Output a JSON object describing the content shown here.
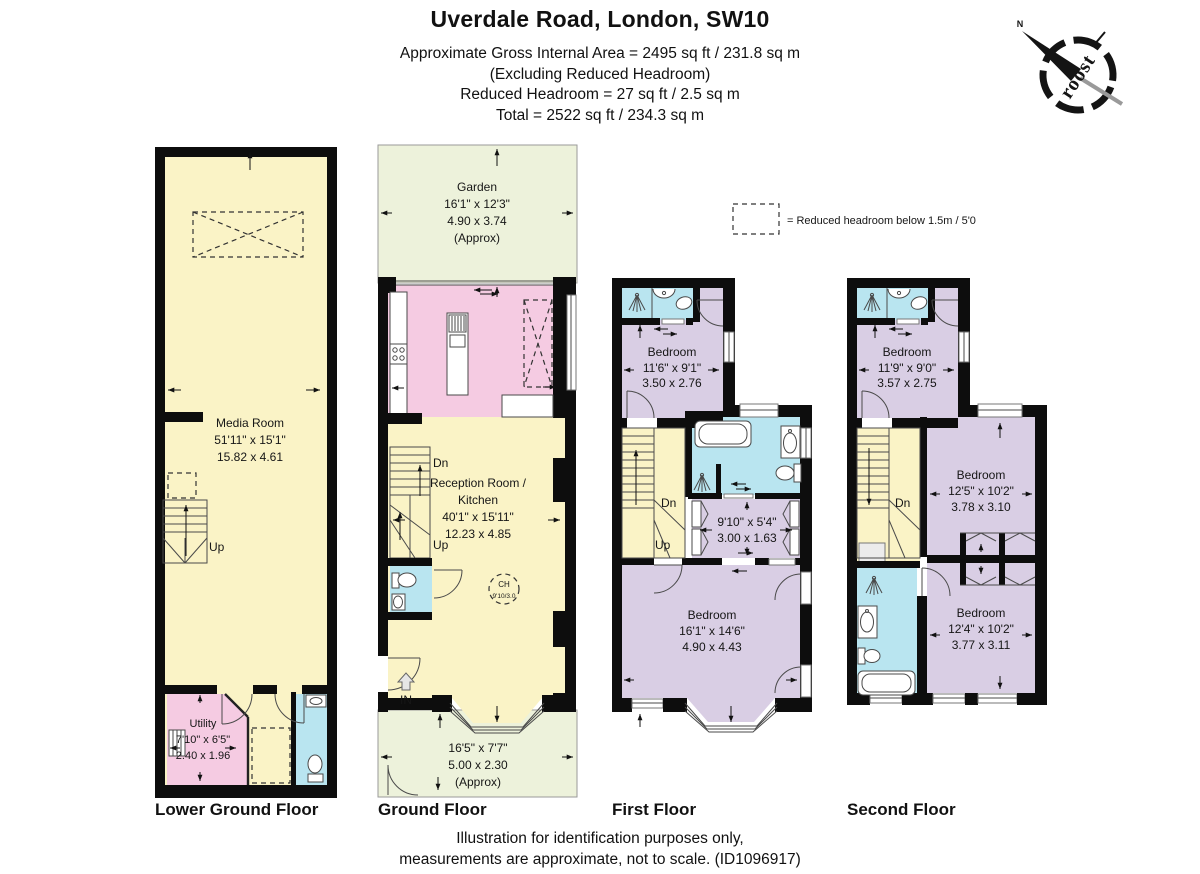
{
  "header": {
    "title": "Uverdale Road, London, SW10",
    "line1": "Approximate Gross Internal Area =  2495 sq ft / 231.8 sq m",
    "line2": "(Excluding Reduced Headroom)",
    "line3": "Reduced Headroom =  27 sq ft / 2.5 sq m",
    "line4": "Total = 2522 sq ft / 234.3 sq m"
  },
  "compass": {
    "brand": "roost",
    "north": "N"
  },
  "legend": {
    "label": "= Reduced headroom below 1.5m / 5'0"
  },
  "floors": {
    "lower_ground": {
      "label": "Lower Ground Floor",
      "media": {
        "name": "Media Room",
        "imperial": "51'11\" x 15'1\"",
        "metric": "15.82 x 4.61"
      },
      "utility": {
        "name": "Utility",
        "imperial": "7'10\" x 6'5\"",
        "metric": "2.40 x 1.96"
      },
      "up": "Up"
    },
    "ground": {
      "label": "Ground Floor",
      "garden": {
        "name": "Garden",
        "imperial": "16'1\" x 12'3\"",
        "metric": "4.90 x 3.74",
        "approx": "(Approx)"
      },
      "reception": {
        "name1": "Reception Room /",
        "name2": "Kitchen",
        "imperial": "40'1\" x 15'11\"",
        "metric": "12.23 x 4.85"
      },
      "ceiling_height": {
        "line1": "CH",
        "line2": "9'10/3.0"
      },
      "front_garden": {
        "imperial": "16'5\" x 7'7\"",
        "metric": "5.00 x 2.30",
        "approx": "(Approx)"
      },
      "dn": "Dn",
      "up": "Up",
      "entrance": "IN"
    },
    "first": {
      "label": "First Floor",
      "bedroom1": {
        "name": "Bedroom",
        "imperial": "11'6\" x 9'1\"",
        "metric": "3.50 x 2.76"
      },
      "dressing": {
        "imperial": "9'10\" x 5'4\"",
        "metric": "3.00 x 1.63"
      },
      "bedroom2": {
        "name": "Bedroom",
        "imperial": "16'1\" x 14'6\"",
        "metric": "4.90 x 4.43"
      },
      "dn": "Dn",
      "up": "Up"
    },
    "second": {
      "label": "Second Floor",
      "bedroom1": {
        "name": "Bedroom",
        "imperial": "11'9\" x 9'0\"",
        "metric": "3.57 x 2.75"
      },
      "bedroom2": {
        "name": "Bedroom",
        "imperial": "12'5\" x 10'2\"",
        "metric": "3.78 x 3.10"
      },
      "bedroom3": {
        "name": "Bedroom",
        "imperial": "12'4\" x 10'2\"",
        "metric": "3.77 x 3.11"
      },
      "dn": "Dn"
    }
  },
  "footer": {
    "line1": "Illustration for identification purposes only,",
    "line2": "measurements are approximate, not to scale. (ID1096917)"
  },
  "colors": {
    "wall": "#0d0d0d",
    "room_yellow": "#faf3c6",
    "room_pink": "#f5cbe2",
    "room_blue": "#b9e5f0",
    "room_lavender": "#d9cee4",
    "garden_green": "#edf2db",
    "line": "#4a4a4a"
  }
}
